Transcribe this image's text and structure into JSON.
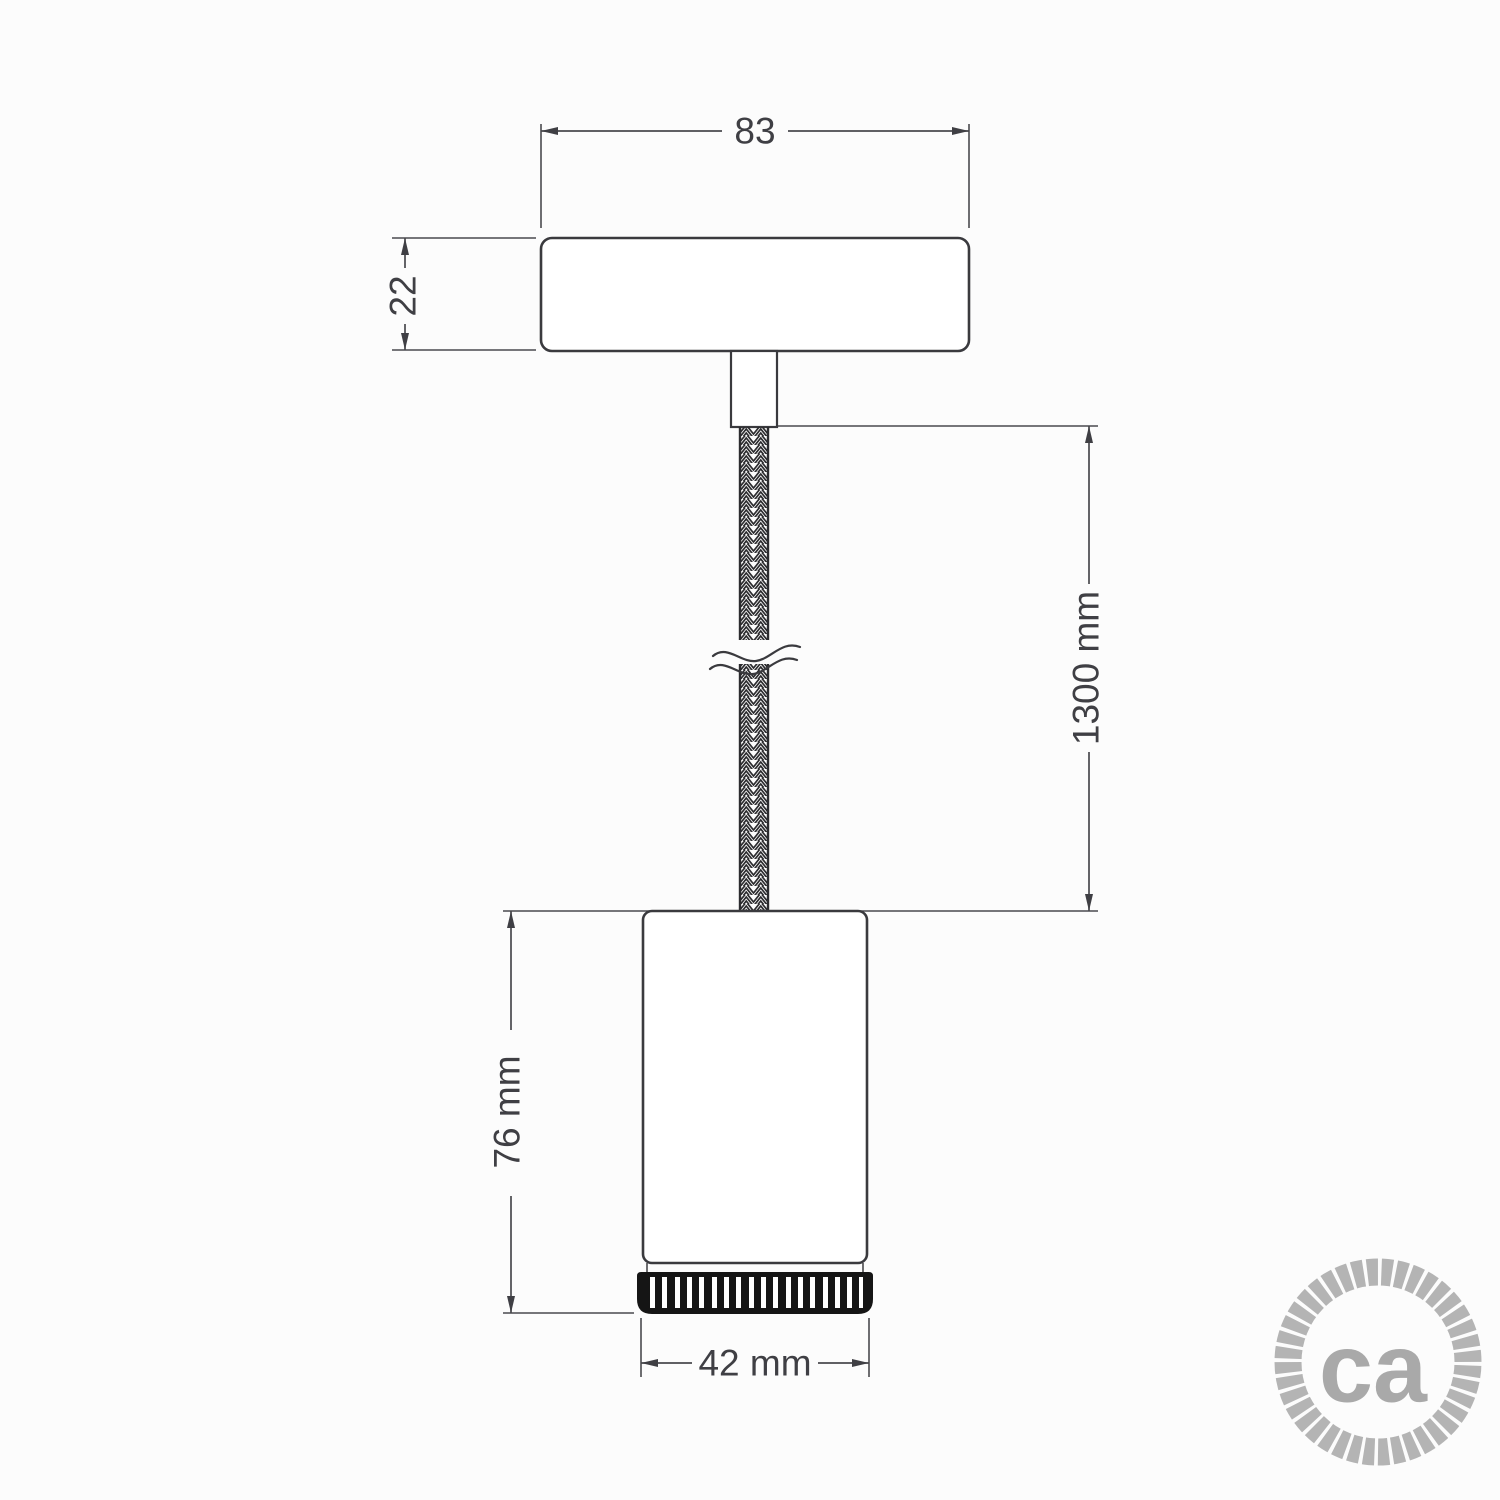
{
  "title": "Pendant spotlight technical drawing",
  "dimensions": {
    "ceiling_rose_width": "83",
    "ceiling_rose_height": "22",
    "cable_length": "1300 mm",
    "spotlight_height": "76 mm",
    "spotlight_diameter": "42 mm"
  },
  "logo": {
    "text": "ca"
  },
  "colors": {
    "line": "#3a3a3e",
    "dimension_line": "#4a4a4e",
    "text": "#3f3f44",
    "ring_black": "#151515",
    "logo_gray": "#b4b4b4",
    "logo_text_gray": "#a9a9a9",
    "background": "#fcfcfc"
  }
}
